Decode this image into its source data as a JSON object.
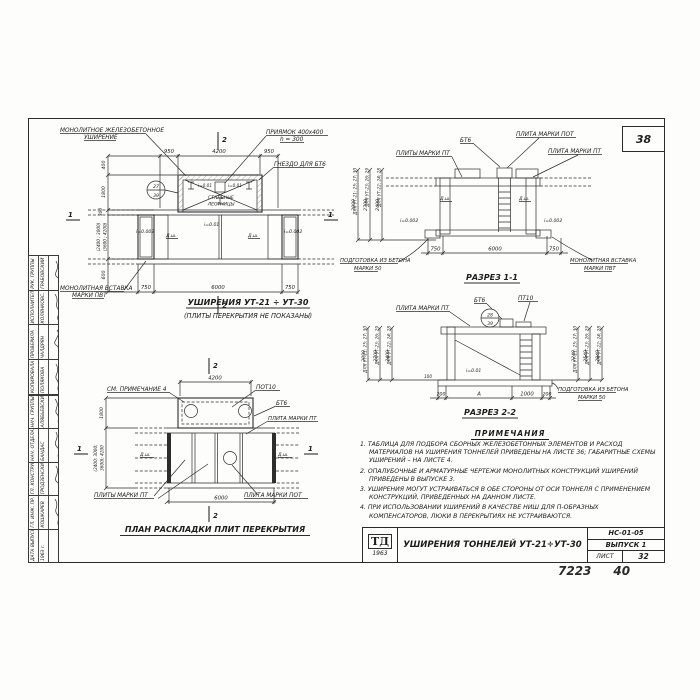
{
  "sheet": {
    "page_number": "38",
    "handwritten_left": "7223",
    "handwritten_right": "40"
  },
  "stamp": {
    "group1": [
      {
        "role": "РУК. ГРУППЫ",
        "name": "ГРАБОВСКИЙ"
      },
      {
        "role": "ИСПОЛНИТЕЛЬ",
        "name": "КОЛЯНКОВС."
      },
      {
        "role": "ПРОВЕРИЛА",
        "name": "ЧАЛДРЯН"
      },
      {
        "role": "КОПИРОВАЛА",
        "name": "ПОЛЯКОВА"
      }
    ],
    "group2": [
      {
        "role": "НАЧ. ГРУППЫ",
        "name": "АЛЯБЬЕВСКИЙ"
      },
      {
        "role": "НАЧ. ОТДЕЛА",
        "name": "БАНДАС"
      },
      {
        "role": "ГЛ. КОНСТРУКТОР",
        "name": "ГРОДЗЕНСКИЙ"
      },
      {
        "role": "ГЛ. ИНЖ. ПР.",
        "name": "КОШКАРЕВ"
      },
      {
        "role": "ДАТА ВЫПУСКА",
        "name": "1963 г."
      }
    ]
  },
  "title_block": {
    "logo_top": "ТД",
    "logo_year": "1963",
    "title": "УШИРЕНИЯ ТОННЕЛЕЙ УТ-21÷УТ-30",
    "doc_number": "НС-01-05",
    "issue": "ВЫПУСК 1",
    "sheet_label": "ЛИСТ",
    "sheet_number": "32"
  },
  "plan_top": {
    "title": "УШИРЕНИЯ УТ-21 ÷ УТ-30",
    "subtitle": "(ПЛИТЫ ПЕРЕКРЫТИЯ НЕ ПОКАЗАНЫ)",
    "label_widening_1": "МОНОЛИТНОЕ ЖЕЛЕЗОБЕТОННОЕ",
    "label_widening_2": "УШИРЕНИЕ",
    "label_pit_1": "ПРИЯМОК 400х400",
    "label_pit_2": "h = 300",
    "label_socket": "ГНЕЗДО ДЛЯ БТ6",
    "label_ladders_1": "СТАЛЬНЫЕ",
    "label_ladders_2": "ЛЕСТНИЦЫ",
    "label_insert_1": "МОНОЛИТНАЯ ВСТАВКА",
    "label_insert_2": "МАРКИ ПВТ",
    "detail_top": "27",
    "detail_bottom": "39",
    "slope_left": "i=0.002",
    "slope_right": "i=0.002",
    "slope_mid": "i=0.01",
    "slope_pit_left": "i=0.01",
    "slope_pit_right": "i=0.01",
    "axis_left": "Д.ш.",
    "axis_right": "Д.ш.",
    "dims_top": [
      "950",
      "4200",
      "950"
    ],
    "dims_bottom": [
      "750",
      "6000",
      "750"
    ],
    "dims_left": [
      "400",
      "1800",
      "300",
      "(2400 ; 3000)",
      "(3600 ; 4200)",
      "600"
    ],
    "mark_1": "1",
    "mark_2": "2"
  },
  "section11": {
    "title": "РАЗРЕЗ 1-1",
    "col_labels": [
      "ДЛЯ УТ-21; 25; 27; 30",
      "ДЛЯ УТ-23; 26; 29",
      "ДЛЯ УТ-22; 24; 28"
    ],
    "col_values": [
      "3000",
      "2700",
      "2400"
    ],
    "label_bt6": "БТ6",
    "label_pt_plural": "ПЛИТЫ МАРКИ ПТ",
    "label_pot": "ПЛИТА МАРКИ ПОТ",
    "label_pt": "ПЛИТА МАРКИ ПТ",
    "axis_left": "Д.ш.",
    "axis_right": "Д.ш.",
    "slope_left": "i=0.002",
    "slope_right": "i=0.002",
    "label_prep_1": "ПОДГОТОВКА ИЗ БЕТОНА",
    "label_prep_2": "МАРКИ 50",
    "label_insert_1": "МОНОЛИТНАЯ ВСТАВКА",
    "label_insert_2": "МАРКИ ПВТ",
    "dims_bottom": [
      "750",
      "6000",
      "750"
    ]
  },
  "section22": {
    "title": "РАЗРЕЗ 2-2",
    "left_labels": [
      "ДЛЯ УТ-21; 25; 27; 30",
      "ДЛЯ УТ-23; 26; 29",
      "ДЛЯ УТ-22; 24; 28"
    ],
    "left_values": [
      "3000",
      "2700",
      "2400"
    ],
    "right_labels": [
      "ДЛЯ УТ-21; 25; 27; 30",
      "ДЛЯ УТ-23; 26; 29",
      "ДЛЯ УТ-22; 24; 28"
    ],
    "right_values": [
      "2240",
      "2540",
      "2840"
    ],
    "label_pt": "ПЛИТА МАРКИ ПТ",
    "label_bt6": "БТ6",
    "label_pt10": "ПТ10",
    "detail_top": "28",
    "detail_bottom": "39",
    "slope": "i=0.01",
    "dim_small": "100",
    "label_prep_1": "ПОДГОТОВКА ИЗ БЕТОНА",
    "label_prep_2": "МАРКИ 50",
    "dims_bottom": [
      "200",
      "А",
      "1000",
      "200"
    ]
  },
  "plan_slabs": {
    "title": "ПЛАН РАСКЛАДКИ ПЛИТ ПЕРЕКРЫТИЯ",
    "label_note": "СМ. ПРИМЕЧАНИЕ 4",
    "label_pot10": "ПОТ10",
    "label_bt6": "БТ6",
    "label_pt": "ПЛИТА МАРКИ ПТ",
    "label_pt_plural": "ПЛИТЫ МАРКИ ПТ",
    "label_pot": "ПЛИТА МАРКИ ПОТ",
    "axis_left": "Д.ш.",
    "axis_right": "Д.ш.",
    "dim_top": "4200",
    "dim_bottom": "6000",
    "dim_left_1": "1800",
    "dim_left_2": "(2400; 3000;",
    "dim_left_3": "3600); 4200",
    "mark_1": "1",
    "mark_2": "2"
  },
  "notes": {
    "header": "ПРИМЕЧАНИЯ",
    "items": [
      "1. ТАБЛИЦА ДЛЯ ПОДБОРА СБОРНЫХ ЖЕЛЕЗОБЕТОННЫХ ЭЛЕМЕНТОВ И РАСХОД МАТЕРИАЛОВ НА УШИРЕНИЯ ТОННЕЛЕЙ ПРИВЕДЕНЫ НА ЛИСТЕ 36; ГАБАРИТНЫЕ СХЕМЫ УШИРЕНИЙ – НА ЛИСТЕ 4.",
      "2. ОПАЛУБОЧНЫЕ И АРМАТУРНЫЕ ЧЕРТЕЖИ МОНОЛИТНЫХ КОНСТРУКЦИЙ УШИРЕНИЙ ПРИВЕДЕНЫ В ВЫПУСКЕ 3.",
      "3. УШИРЕНИЯ МОГУТ УСТРАИВАТЬСЯ В ОБЕ СТОРОНЫ ОТ ОСИ ТОННЕЛЯ С ПРИМЕНЕНИЕМ КОНСТРУКЦИЙ, ПРИВЕДЕННЫХ НА ДАННОМ ЛИСТЕ.",
      "4. ПРИ ИСПОЛЬЗОВАНИИ УШИРЕНИЙ В КАЧЕСТВЕ НИШ ДЛЯ П-ОБРАЗНЫХ КОМПЕНСАТОРОВ, ЛЮКИ В ПЕРЕКРЫТИЯХ НЕ УСТРАИВАЮТСЯ."
    ]
  }
}
